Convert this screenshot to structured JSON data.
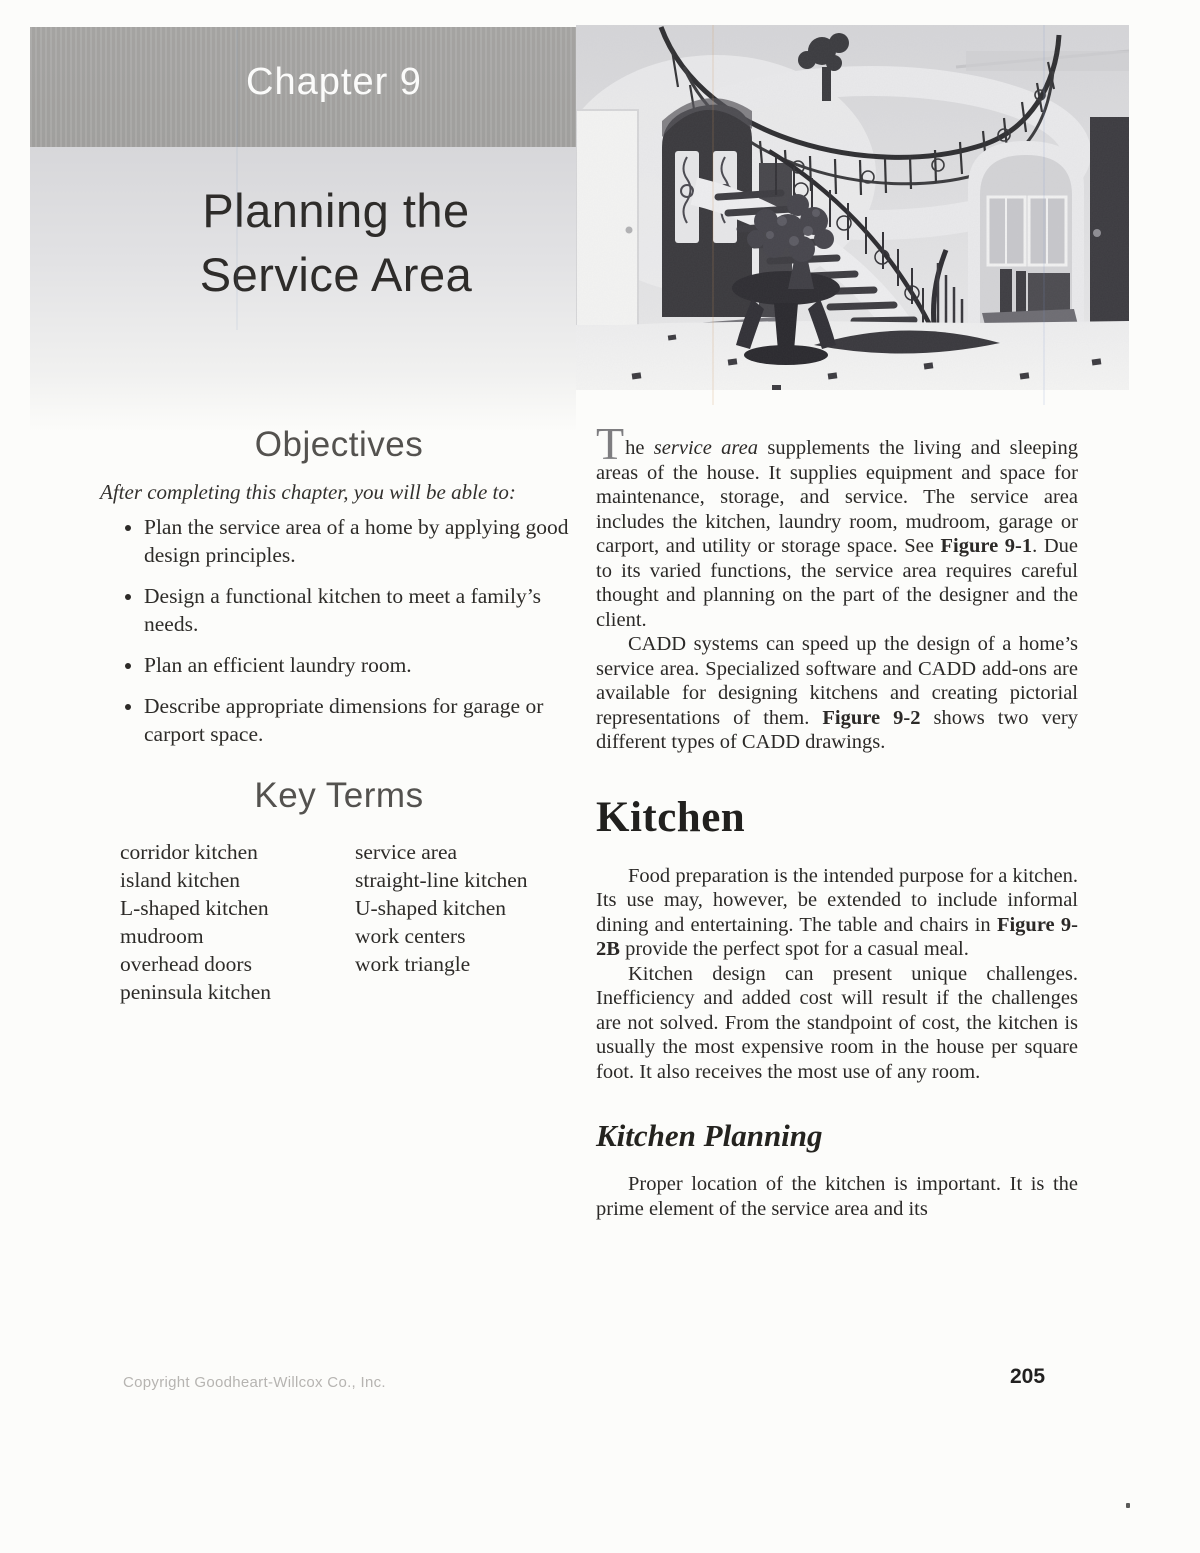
{
  "colors": {
    "header_band": "#a8a7a5",
    "title_panel_top": "#d7d7da",
    "heading_gray": "#54524f",
    "body_text": "#2b2927",
    "footer_gray": "#b6b4b1"
  },
  "header": {
    "chapter_label": "Chapter 9",
    "title_line1": "Planning the",
    "title_line2": "Service Area"
  },
  "photo": {
    "semantic": "foyer-spiral-staircase-photo"
  },
  "objectives": {
    "heading": "Objectives",
    "intro": "After completing this chapter, you will be able to:",
    "items": [
      "Plan the service area of a home by applying good design principles.",
      "Design a functional kitchen to meet a family’s needs.",
      "Plan an efficient laundry room.",
      "Describe appropriate dimensions for garage or carport space."
    ]
  },
  "key_terms": {
    "heading": "Key Terms",
    "col1": [
      "corridor kitchen",
      "island kitchen",
      "L-shaped kitchen",
      "mudroom",
      "overhead doors",
      "peninsula kitchen"
    ],
    "col2": [
      "service area",
      "straight-line kitchen",
      "U-shaped kitchen",
      "work centers",
      "work triangle"
    ]
  },
  "intro_section": {
    "p1": {
      "dropcap": "T",
      "s1": "he ",
      "em": "service area",
      "s2": " supplements the living and sleeping areas of the house. It supplies equipment and space for maintenance, storage, and service. The service area includes the kitchen, laundry room, mudroom, garage or carport, and utility or storage space. See ",
      "b": "Figure 9-1",
      "s3": ". Due to its varied functions, the service area requires careful thought and planning on the part of the designer and the client."
    },
    "p2": {
      "s1": "CADD systems can speed up the design of a home’s service area. Specialized software and CADD add-ons are available for designing kitchens and creating pictorial representations of them. ",
      "b": "Figure 9-2",
      "s2": " shows two very different types of CADD drawings."
    }
  },
  "kitchen_section": {
    "heading": "Kitchen",
    "p1": {
      "s1": "Food preparation is the intended purpose for a kitchen. Its use may, however, be extended to include informal dining and entertaining. The table and chairs in ",
      "b": "Figure 9-2B",
      "s2": " provide the perfect spot for a casual meal."
    },
    "p2": "Kitchen design can present unique challenges. Inefficiency and added cost will result if the challenges are not solved. From the standpoint of cost, the kitchen is usually the most expensive room in the house per square foot. It also receives the most use of any room."
  },
  "kitchen_planning_section": {
    "heading": "Kitchen Planning",
    "p1": "Proper location of the kitchen is important. It is the prime element of the service area and its"
  },
  "footer": {
    "copyright": "Copyright Goodheart-Willcox Co., Inc.",
    "page_number": "205"
  }
}
